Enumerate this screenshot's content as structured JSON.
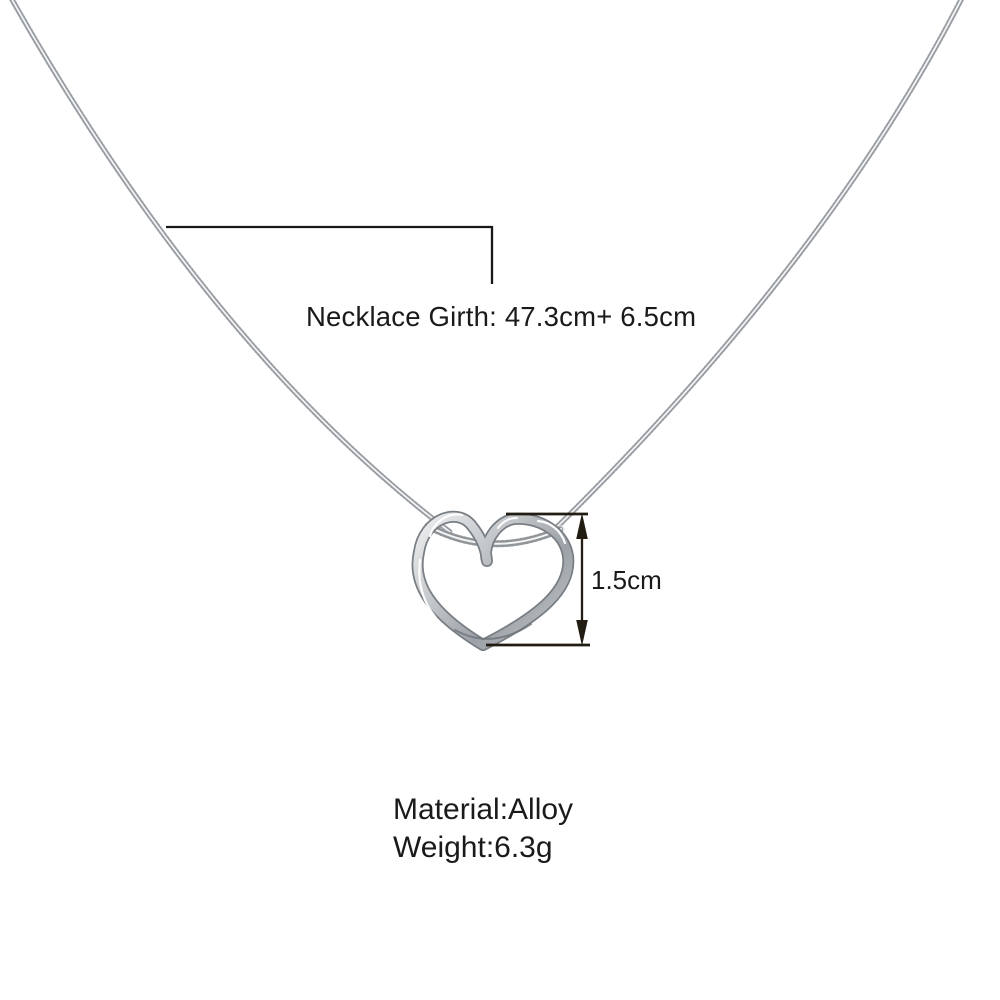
{
  "image": {
    "description": "product-photo-silver-heart-necklace",
    "background_color": "#ffffff",
    "annotation_color": "#221c13",
    "leader_line_color": "#191919",
    "chain_silver_light": "#e3e5e7",
    "chain_silver_dark": "#8b9196",
    "pendant_silver_light": "#eef0f1",
    "pendant_silver_dark": "#878d93",
    "annotations": {
      "girth_label": "Necklace Girth: 47.3cm+ 6.5cm",
      "pendant_size_label": "1.5cm"
    },
    "specs": {
      "material_label": "Material:Alloy",
      "weight_label": "Weight:6.3g"
    }
  }
}
